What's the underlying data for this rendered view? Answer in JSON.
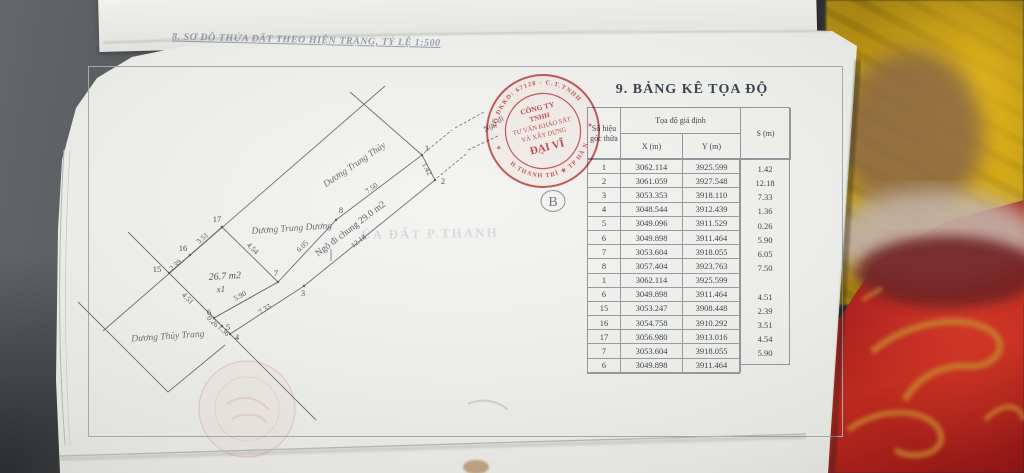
{
  "photo": {
    "desk_color": "#4a4e52",
    "page_color": "#ededea",
    "fabric_yellow": "#c9a215",
    "blanket_red": "#a81f1f",
    "blanket_pattern_orange": "#c8822e",
    "stamp_red": "#c64a4a"
  },
  "page": {
    "map_title": "8. SƠ ĐỒ THỬA ĐẤT THEO HIỆN TRẠNG, TỶ LỆ 1:500"
  },
  "table": {
    "title": "9. BẢNG KÊ TỌA ĐỘ",
    "header": {
      "point_no_line1": "Số hiệu",
      "point_no_line2": "góc thửa",
      "group": "Tọa độ giả định",
      "x": "X (m)",
      "y": "Y (m)",
      "s": "S (m)"
    },
    "rows": [
      {
        "id": "1",
        "x": "3062.114",
        "y": "3925.599"
      },
      {
        "id": "2",
        "x": "3061.059",
        "y": "3927.548"
      },
      {
        "id": "3",
        "x": "3053.353",
        "y": "3918.110"
      },
      {
        "id": "4",
        "x": "3048.544",
        "y": "3912.439"
      },
      {
        "id": "5",
        "x": "3049.096",
        "y": "3911.529"
      },
      {
        "id": "6",
        "x": "3049.898",
        "y": "3911.464"
      },
      {
        "id": "7",
        "x": "3053.604",
        "y": "3918.055"
      },
      {
        "id": "8",
        "x": "3057.404",
        "y": "3923.763"
      },
      {
        "id": "1",
        "x": "3062.114",
        "y": "3925.599"
      },
      {
        "id": "6",
        "x": "3049.898",
        "y": "3911.464"
      },
      {
        "id": "15",
        "x": "3053.247",
        "y": "3908.448"
      },
      {
        "id": "16",
        "x": "3054.758",
        "y": "3910.292"
      },
      {
        "id": "17",
        "x": "3056.980",
        "y": "3913.016"
      },
      {
        "id": "7",
        "x": "3053.604",
        "y": "3918.055"
      },
      {
        "id": "6",
        "x": "3049.898",
        "y": "3911.464"
      }
    ],
    "s_values": [
      "1.42",
      "12.18",
      "7.33",
      "1.36",
      "0.26",
      "5.90",
      "6.05",
      "7.50",
      "4.51",
      "2.39",
      "3.51",
      "4.54",
      "5.90"
    ]
  },
  "diagram": {
    "streets": {
      "top": "Dương Trung Thủy",
      "mid": "Dương Trung Dương",
      "bottom": "Dương Thủy Trang"
    },
    "lane_label": "Ngõ đi chung 29.0 m2",
    "lane_exit": "Ngõ đi",
    "area_label": "26.7 m2",
    "plot_code": "x1",
    "marker_b": "B",
    "points": [
      "1",
      "2",
      "3",
      "4",
      "5",
      "6",
      "7",
      "8",
      "15",
      "16",
      "17"
    ],
    "edges": {
      "e12": "1.42",
      "e23": "12.18",
      "e34": "7.33",
      "e45": "1.36",
      "e56": "0.26",
      "e67": "5.90",
      "e78": "6.05",
      "e81": "7.50",
      "e6_15": "4.51",
      "e15_16": "2.39",
      "e16_17": "3.51",
      "e17_7": "4.54"
    }
  },
  "stamp": {
    "arc_top": "SỐ ĐKKD: 67128 - C.T.TNHH",
    "arc_bottom": "H.THANH TRÌ ★ TP HÀ NỘI",
    "star": "✶",
    "line1": "CÔNG TY",
    "line2": "TNHH",
    "line3": "TƯ VẤN KHẢO SÁT",
    "line4": "VÀ XÂY DỰNG",
    "line5": "ĐẠI VĨ"
  },
  "ghost": {
    "bleed_line": "ỦA ĐẤT P.THANH"
  }
}
